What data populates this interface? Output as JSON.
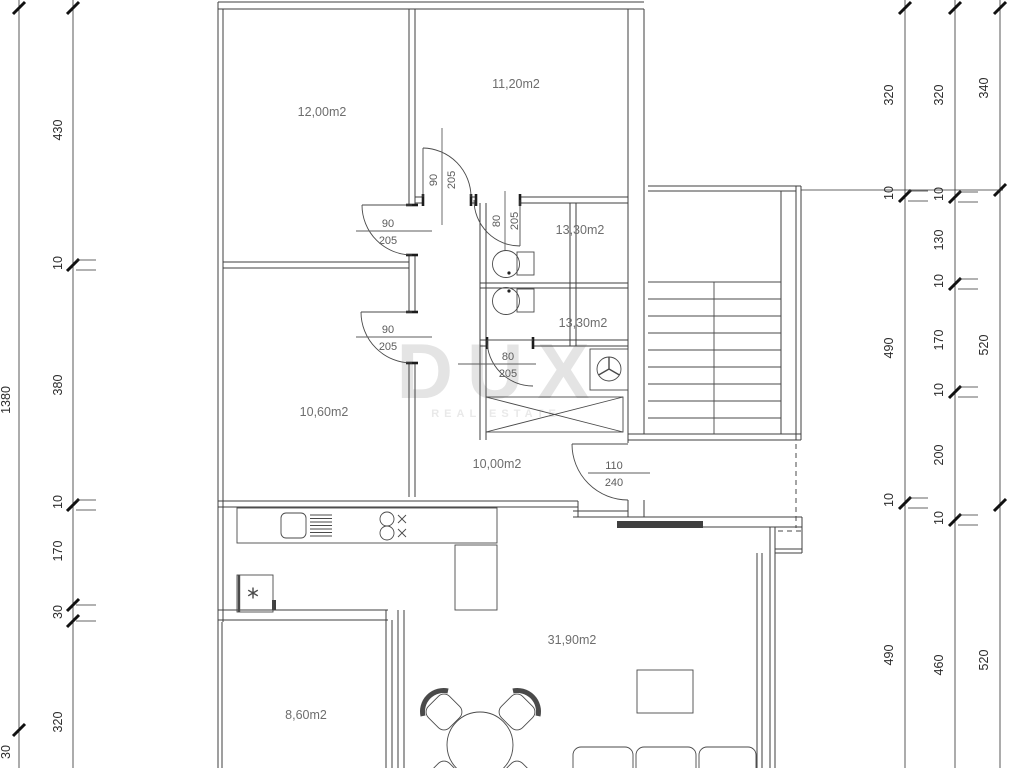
{
  "watermark": {
    "title": "DUX",
    "subtitle": "REAL ESTATE"
  },
  "rooms": {
    "bedroom_a": "12,00m2",
    "bedroom_b": "11,20m2",
    "room_c": "13,30m2",
    "room_d": "13,30m2",
    "bedroom_e": "10,60m2",
    "hallway": "10,00m2",
    "living": "31,90m2",
    "terrace": "8,60m2"
  },
  "doors": {
    "a": {
      "w": "90",
      "h": "205"
    },
    "b": {
      "w": "90",
      "h": "205"
    },
    "c": {
      "w": "90",
      "h": "205"
    },
    "d": {
      "w": "80",
      "h": "205"
    },
    "e": {
      "w": "80",
      "h": "205"
    },
    "entry": {
      "w": "110",
      "h": "240"
    }
  },
  "dims": {
    "total": "1380",
    "total_seg": "30",
    "left": [
      "430",
      "10",
      "380",
      "10",
      "170",
      "30",
      "320"
    ],
    "right_a": [
      "320",
      "10",
      "490",
      "10",
      "490"
    ],
    "right_b": [
      "320",
      "10",
      "130",
      "10",
      "170",
      "10",
      "200",
      "10",
      "460"
    ],
    "right_c": [
      "340",
      "520",
      "520"
    ]
  },
  "colors": {
    "wall": "#3f3f3f",
    "dim_text": "#2c2c2c",
    "room_text": "#6e6e6e",
    "watermark": "#e4e4e4",
    "background": "#ffffff"
  }
}
